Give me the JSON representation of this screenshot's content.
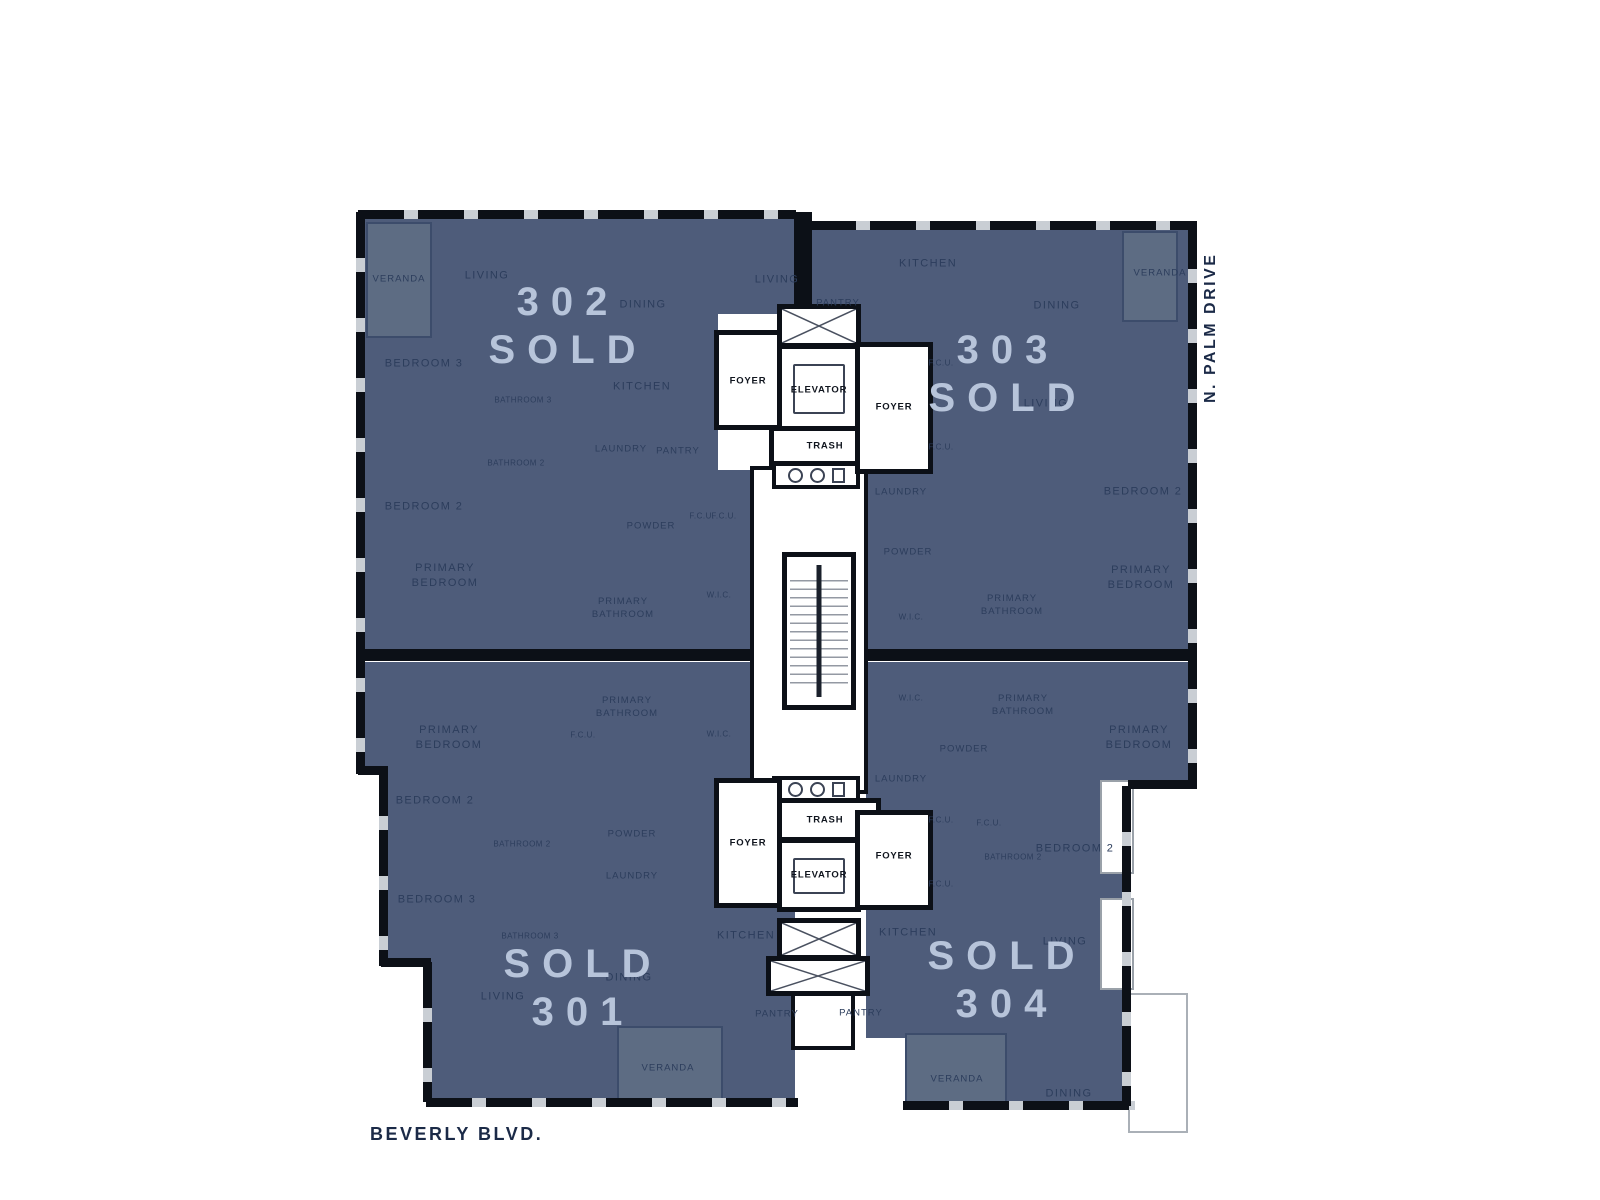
{
  "palette": {
    "unit_fill": "#4e5c7a",
    "veranda_fill": "#5d6c83",
    "wall": "#0c1017",
    "room_text": "#2c3d5c",
    "sold_text": "#b7c4da",
    "street_text": "#1b2a47",
    "window_line": "#c9ced4"
  },
  "streets": {
    "bottom": "BEVERLY BLVD.",
    "right": "N. PALM DRIVE"
  },
  "core": {
    "foyer": "FOYER",
    "elevator": "ELEVATOR",
    "trash": "TRASH"
  },
  "units": {
    "u302": {
      "number": "302",
      "status": "SOLD",
      "rooms": {
        "veranda": "VERANDA",
        "living_a": "LIVING",
        "living_b": "LIVING",
        "dining": "DINING",
        "kitchen": "KITCHEN",
        "bedroom3": "BEDROOM 3",
        "bathroom3": "BATHROOM 3",
        "bathroom2": "BATHROOM 2",
        "laundry": "LAUNDRY",
        "pantry": "PANTRY",
        "bedroom2": "BEDROOM 2",
        "powder": "POWDER",
        "fcu_a": "F.C.U.",
        "fcu_b": "F.C.U.",
        "primary_bedroom": "PRIMARY BEDROOM",
        "primary_bathroom": "PRIMARY BATHROOM",
        "wic": "W.I.C."
      }
    },
    "u303": {
      "number": "303",
      "status": "SOLD",
      "rooms": {
        "pantry": "PANTRY",
        "kitchen": "KITCHEN",
        "dining": "DINING",
        "veranda": "VERANDA",
        "living": "LIVING",
        "fcu_a": "F.C.U.",
        "fcu_b": "F.C.U.",
        "laundry": "LAUNDRY",
        "bedroom2": "BEDROOM 2",
        "powder": "POWDER",
        "wic": "W.I.C.",
        "primary_bathroom": "PRIMARY BATHROOM",
        "primary_bedroom": "PRIMARY BEDROOM"
      }
    },
    "u301": {
      "number": "301",
      "status": "SOLD",
      "rooms": {
        "primary_bedroom": "PRIMARY BEDROOM",
        "primary_bathroom": "PRIMARY BATHROOM",
        "fcu": "F.C.U.",
        "wic": "W.I.C.",
        "bedroom2": "BEDROOM 2",
        "bathroom2": "BATHROOM 2",
        "powder": "POWDER",
        "laundry": "LAUNDRY",
        "bedroom3": "BEDROOM 3",
        "bathroom3": "BATHROOM 3",
        "kitchen": "KITCHEN",
        "dining": "DINING",
        "living": "LIVING",
        "pantry": "PANTRY",
        "veranda": "VERANDA"
      }
    },
    "u304": {
      "number": "304",
      "status": "SOLD",
      "rooms": {
        "wic": "W.I.C.",
        "primary_bathroom": "PRIMARY BATHROOM",
        "primary_bedroom": "PRIMARY BEDROOM",
        "powder": "POWDER",
        "laundry": "LAUNDRY",
        "fcu_a": "F.C.U.",
        "fcu_b": "F.C.U.",
        "fcu_c": "F.C.U.",
        "bathroom2": "BATHROOM 2",
        "bedroom2": "BEDROOM 2",
        "kitchen": "KITCHEN",
        "living": "LIVING",
        "dining": "DINING",
        "veranda": "VERANDA",
        "pantry": "PANTRY"
      }
    }
  }
}
